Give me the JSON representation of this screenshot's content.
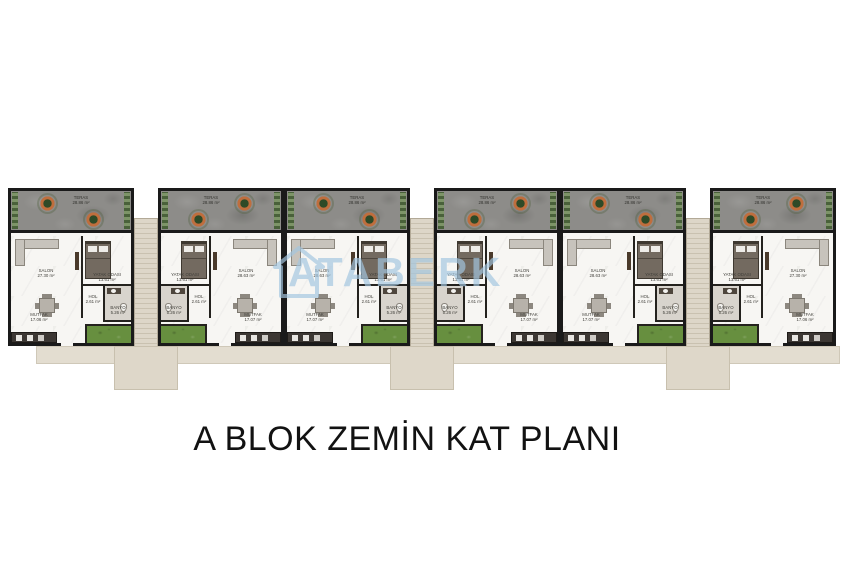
{
  "page_title": "A BLOK ZEMİN KAT PLANI",
  "watermark": {
    "text": "ATABERK",
    "icon": "house-outline-icon",
    "color": "#a3c6e0"
  },
  "palette": {
    "wall": "#1a1a1a",
    "terrace_concrete": "#8d8c89",
    "interior_floor": "#f7f6f3",
    "bathroom_floor": "#d8d4cd",
    "grass": "#678f3f",
    "path_beige": "#ddd6c8",
    "watermark_blue": "#a3c6e0",
    "title_text": "#121212"
  },
  "units": [
    {
      "id": 1,
      "mirrored": false,
      "rooms": {
        "teras": {
          "name": "TERAS",
          "area": "28.86 m²"
        },
        "salon": {
          "name": "SALON",
          "area": "27.30 m²"
        },
        "yatak_odasi": {
          "name": "YATAK ODASI",
          "area": "13.61 m²"
        },
        "mutfak": {
          "name": "MUTFAK",
          "area": "17.06 m²"
        },
        "hol": {
          "name": "HOL",
          "area": "2.61 m²"
        },
        "banyo": {
          "name": "BANYO",
          "area": "5.26 m²"
        }
      }
    },
    {
      "id": 2,
      "mirrored": true,
      "rooms": {
        "teras": {
          "name": "TERAS",
          "area": "28.86 m²"
        },
        "salon": {
          "name": "SALON",
          "area": "28.63 m²"
        },
        "yatak_odasi": {
          "name": "YATAK ODASI",
          "area": "13.61 m²"
        },
        "mutfak": {
          "name": "MUTFAK",
          "area": "17.07 m²"
        },
        "hol": {
          "name": "HOL",
          "area": "2.61 m²"
        },
        "banyo": {
          "name": "BANYO",
          "area": "5.26 m²"
        }
      }
    },
    {
      "id": 3,
      "mirrored": false,
      "rooms": {
        "teras": {
          "name": "TERAS",
          "area": "28.86 m²"
        },
        "salon": {
          "name": "SALON",
          "area": "28.63 m²"
        },
        "yatak_odasi": {
          "name": "YATAK ODASI",
          "area": "13.61 m²"
        },
        "mutfak": {
          "name": "MUTFAK",
          "area": "17.07 m²"
        },
        "hol": {
          "name": "HOL",
          "area": "2.61 m²"
        },
        "banyo": {
          "name": "BANYO",
          "area": "5.26 m²"
        }
      }
    },
    {
      "id": 4,
      "mirrored": true,
      "rooms": {
        "teras": {
          "name": "TERAS",
          "area": "28.86 m²"
        },
        "salon": {
          "name": "SALON",
          "area": "28.63 m²"
        },
        "yatak_odasi": {
          "name": "YATAK ODASI",
          "area": "13.61 m²"
        },
        "mutfak": {
          "name": "MUTFAK",
          "area": "17.07 m²"
        },
        "hol": {
          "name": "HOL",
          "area": "2.61 m²"
        },
        "banyo": {
          "name": "BANYO",
          "area": "5.26 m²"
        }
      }
    },
    {
      "id": 5,
      "mirrored": false,
      "rooms": {
        "teras": {
          "name": "TERAS",
          "area": "28.86 m²"
        },
        "salon": {
          "name": "SALON",
          "area": "28.63 m²"
        },
        "yatak_odasi": {
          "name": "YATAK ODASI",
          "area": "13.61 m²"
        },
        "mutfak": {
          "name": "MUTFAK",
          "area": "17.07 m²"
        },
        "hol": {
          "name": "HOL",
          "area": "2.61 m²"
        },
        "banyo": {
          "name": "BANYO",
          "area": "5.26 m²"
        }
      }
    },
    {
      "id": 6,
      "mirrored": true,
      "rooms": {
        "teras": {
          "name": "TERAS",
          "area": "28.86 m²"
        },
        "salon": {
          "name": "SALON",
          "area": "27.30 m²"
        },
        "yatak_odasi": {
          "name": "YATAK ODASI",
          "area": "13.61 m²"
        },
        "mutfak": {
          "name": "MUTFAK",
          "area": "17.06 m²"
        },
        "hol": {
          "name": "HOL",
          "area": "2.61 m²"
        },
        "banyo": {
          "name": "BANYO",
          "area": "5.26 m²"
        }
      }
    }
  ]
}
